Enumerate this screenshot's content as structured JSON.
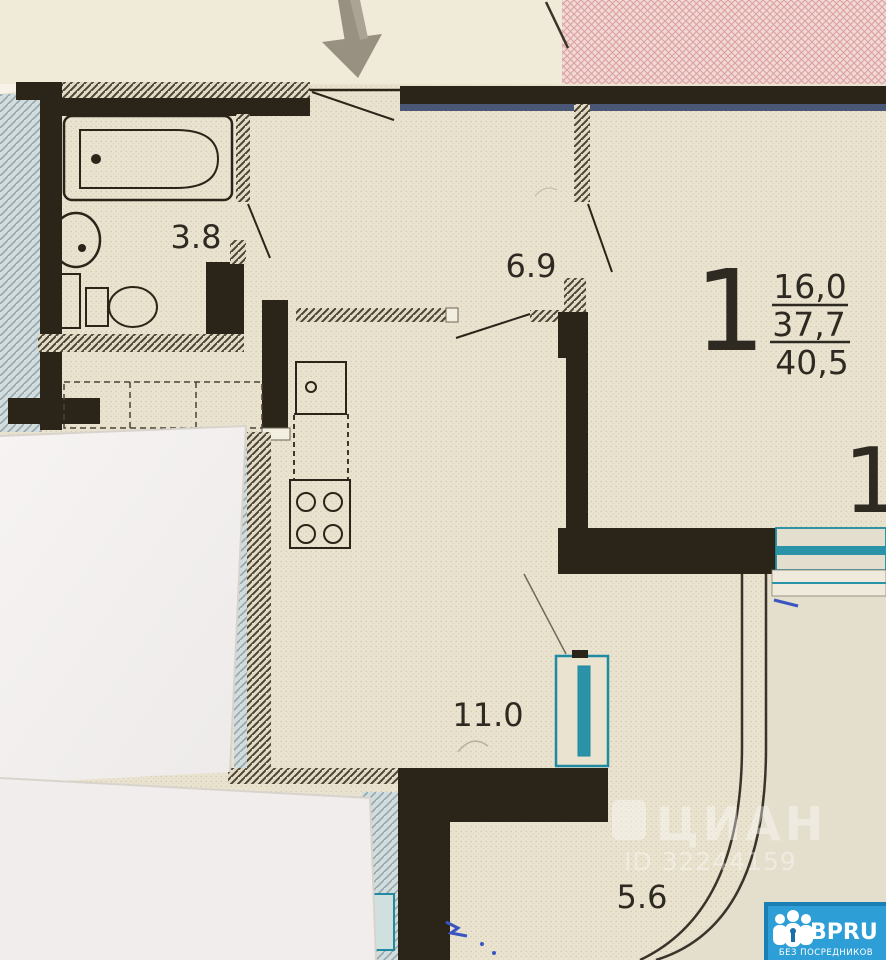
{
  "plan": {
    "type": "apartment-floor-plan-photo",
    "rooms": [
      {
        "name": "bathroom",
        "area_label": "3.8"
      },
      {
        "name": "hallway",
        "area_label": "6.9"
      },
      {
        "name": "kitchen-living-room",
        "area_label": "11.0"
      },
      {
        "name": "balcony",
        "area_label": "5.6"
      }
    ],
    "apartment_summary": {
      "rooms_count": "1",
      "living_area": "16,0",
      "area_without_balcony": "37,7",
      "total_area": "40,5"
    },
    "edge_partial_label": "1"
  },
  "watermark": {
    "brand": "ЦИАН",
    "listing_id": "ID 32244159"
  },
  "badge": {
    "brand": "BPRU",
    "tagline": "БЕЗ ПОСРЕДНИКОВ"
  },
  "colors": {
    "wall": "#2b2418",
    "plan_paper": "#e9e3d0",
    "partition_hatch": "#4b4232",
    "stairwell_blue": "#d3dcdc",
    "neighbor_pink": "#f1d9d7",
    "window_teal": "#1f8aa0",
    "pen_blue": "#3b55c0",
    "badge_blue": "#2e9fd6",
    "watermark_white": "#ffffff"
  }
}
